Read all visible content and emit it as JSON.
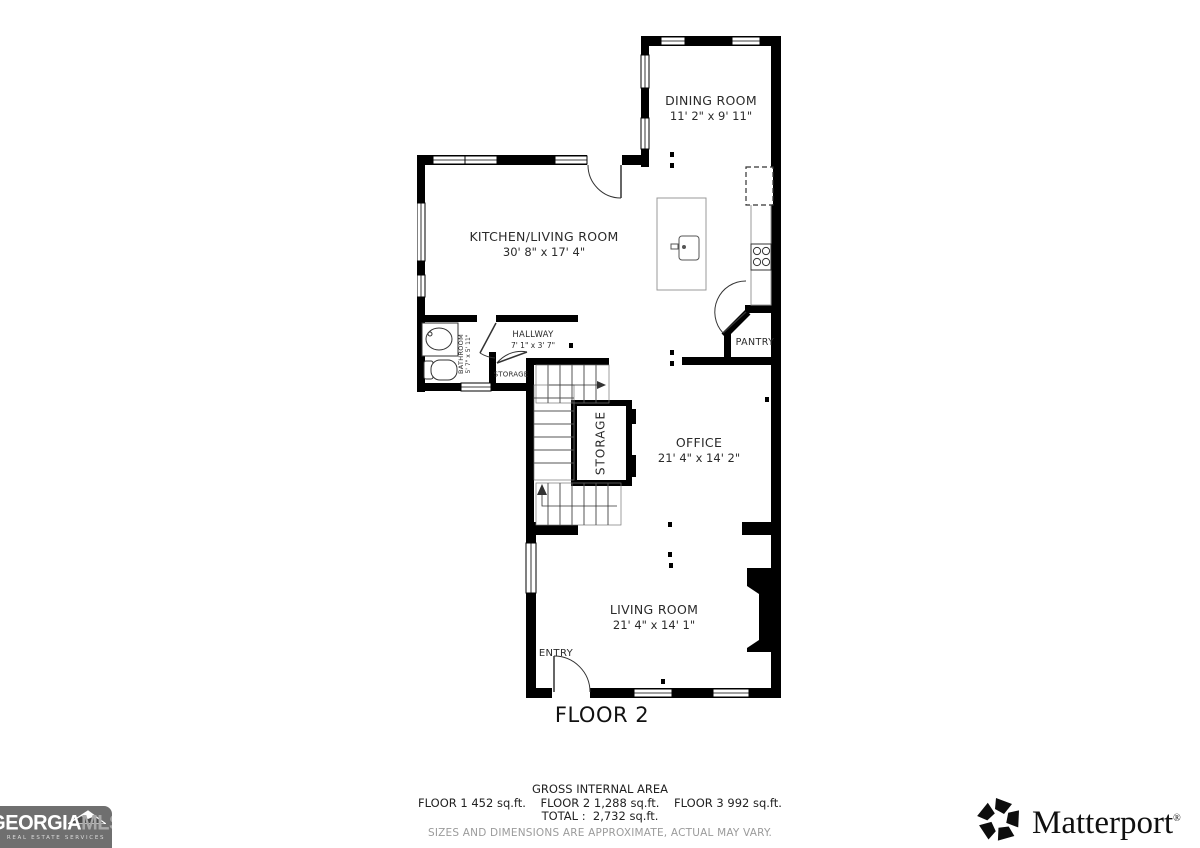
{
  "floor_title": "FLOOR 2",
  "rooms": {
    "dining": {
      "name": "DINING ROOM",
      "dims": "11' 2\" x 9' 11\""
    },
    "kitchen": {
      "name": "KITCHEN/LIVING ROOM",
      "dims": "30' 8\" x 17' 4\""
    },
    "hallway": {
      "name": "HALLWAY",
      "dims": "7' 1\" x 3' 7\""
    },
    "bathroom": {
      "name": "BATHROOM",
      "dims": "5' 7\" x 5' 11\""
    },
    "storage_closet": {
      "name": "STORAGE",
      "dims": ""
    },
    "storage_stairs": {
      "name": "STORAGE",
      "dims": ""
    },
    "office": {
      "name": "OFFICE",
      "dims": "21' 4\" x 14' 2\""
    },
    "pantry": {
      "name": "PANTRY",
      "dims": ""
    },
    "living": {
      "name": "LIVING ROOM",
      "dims": "21' 4\" x 14' 1\""
    },
    "entry": {
      "name": "ENTRY",
      "dims": ""
    }
  },
  "footer": {
    "gross_title": "GROSS INTERNAL AREA",
    "floors_line": "FLOOR 1 452 sq.ft.    FLOOR 2 1,288 sq.ft.    FLOOR 3 992 sq.ft.",
    "total_line": "TOTAL :  2,732 sq.ft.",
    "disclaimer": "SIZES AND DIMENSIONS ARE APPROXIMATE, ACTUAL MAY VARY."
  },
  "logos": {
    "georgia_mls": {
      "word_main": "GEORGIA",
      "word_suffix": "MLS",
      "tagline": "REAL ESTATE SERVICES"
    },
    "matterport": {
      "wordmark": "Matterport",
      "reg": "®"
    }
  },
  "colors": {
    "wall": "#000000",
    "logo_gray": "#6f6f6f",
    "disclaimer_gray": "#9b9b9b"
  }
}
